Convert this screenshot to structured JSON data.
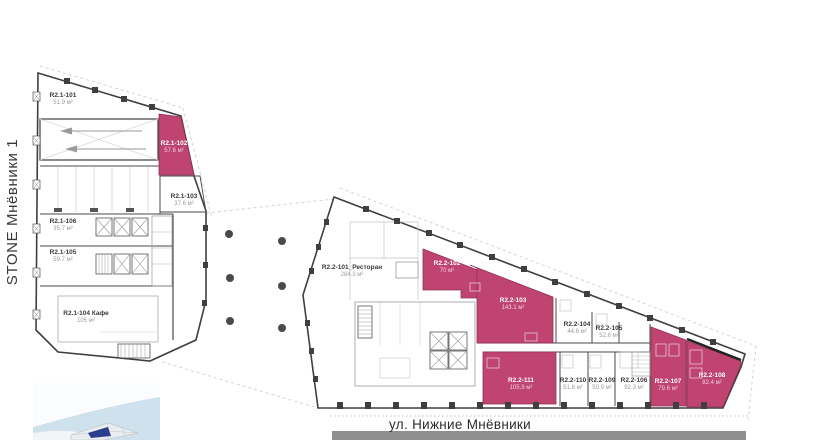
{
  "title": {
    "project": "STONE Мнёвники 1"
  },
  "street": {
    "label": "ул. Нижние Мнёвники"
  },
  "colors": {
    "highlight": "#bf4470",
    "walls": "#3f3f3f",
    "road": "#8f8f8f",
    "water": "#cfe1ed",
    "map_highlight": "#2b3e8f"
  },
  "units": [
    {
      "id": "R2.1-101",
      "area": "51.9 м²",
      "highlighted": false
    },
    {
      "id": "R2.1-102",
      "area": "57.6 м²",
      "highlighted": true
    },
    {
      "id": "R2.1-103",
      "area": "37.6 м²",
      "highlighted": false
    },
    {
      "id": "R2.1-106",
      "area": "35.7 м²",
      "highlighted": false
    },
    {
      "id": "R2.1-105",
      "area": "59.7 м²",
      "highlighted": false
    },
    {
      "id": "R2.1-104 Кафе",
      "area": "105 м²",
      "highlighted": false
    },
    {
      "id": "R2.2-101_Ресторан",
      "area": "284.3 м²",
      "highlighted": false
    },
    {
      "id": "R2.2-102",
      "area": "70 м²",
      "highlighted": true
    },
    {
      "id": "R2.2-103",
      "area": "143.1 м²",
      "highlighted": true
    },
    {
      "id": "R2.2-104",
      "area": "44.8 м²",
      "highlighted": false
    },
    {
      "id": "R2.2-105",
      "area": "52.6 м²",
      "highlighted": false
    },
    {
      "id": "R2.2-111",
      "area": "105.9 м²",
      "highlighted": true
    },
    {
      "id": "R2.2-110",
      "area": "51.8 м²",
      "highlighted": false
    },
    {
      "id": "R2.2-109",
      "area": "50.9 м²",
      "highlighted": false
    },
    {
      "id": "R2.2-106",
      "area": "92.3 м²",
      "highlighted": false
    },
    {
      "id": "R2.2-107",
      "area": "79.6 м²",
      "highlighted": true
    },
    {
      "id": "R2.2-108",
      "area": "82.4 м²",
      "highlighted": true
    }
  ]
}
